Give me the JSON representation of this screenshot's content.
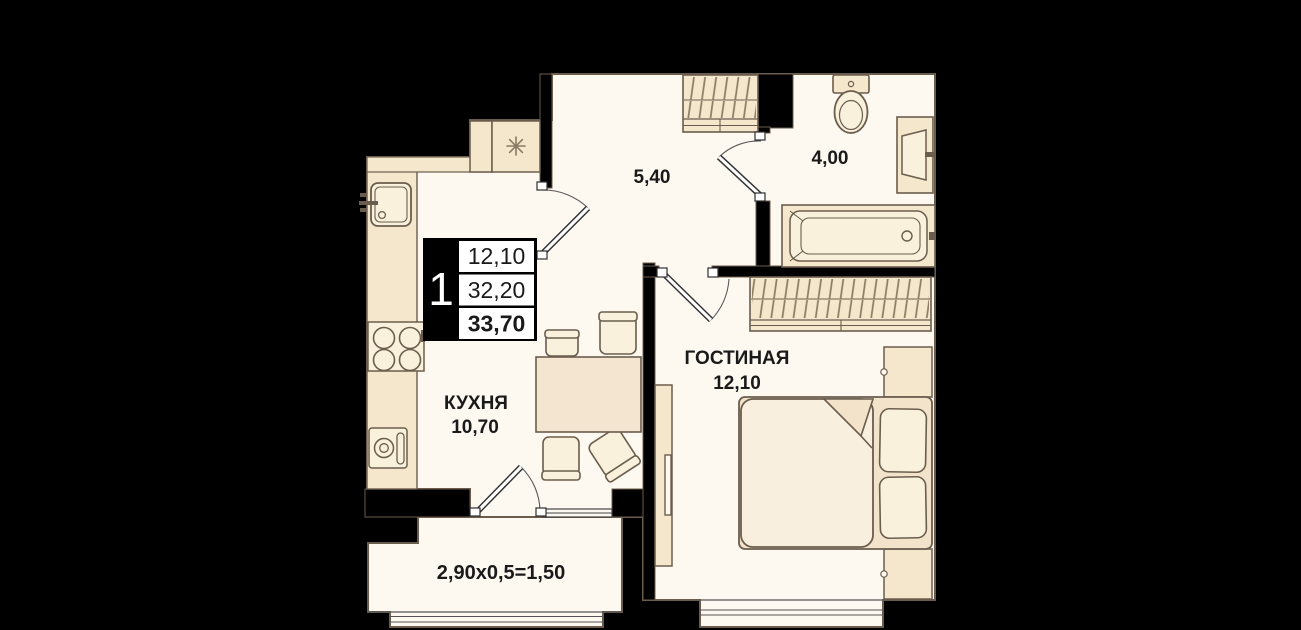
{
  "plan": {
    "badge": {
      "unit": "1",
      "rows": [
        "12,10",
        "32,20",
        "33,70"
      ]
    },
    "rooms": {
      "hallway": {
        "area": "5,40"
      },
      "bathroom": {
        "area": "4,00"
      },
      "kitchen": {
        "name": "КУХНЯ",
        "area": "10,70"
      },
      "living": {
        "name": "ГОСТИНАЯ",
        "area": "12,10"
      },
      "balcony": {
        "formula": "2,90x0,5=1,50"
      }
    },
    "icons": {
      "closet": "eight-ray-star-icon"
    }
  },
  "colors": {
    "wall": "#000000",
    "floor": "#FDF8F0",
    "furn": "#F5E7CC",
    "furnLight": "#FAF1DC",
    "furnMid": "#F2E3CA",
    "table": "#F3E5D0",
    "blanket": "#F8EFDE",
    "outline": "#6B5D4D",
    "hatch": "#8A7A64",
    "text": "#1A1A1A",
    "door": "#2F2F2F"
  }
}
